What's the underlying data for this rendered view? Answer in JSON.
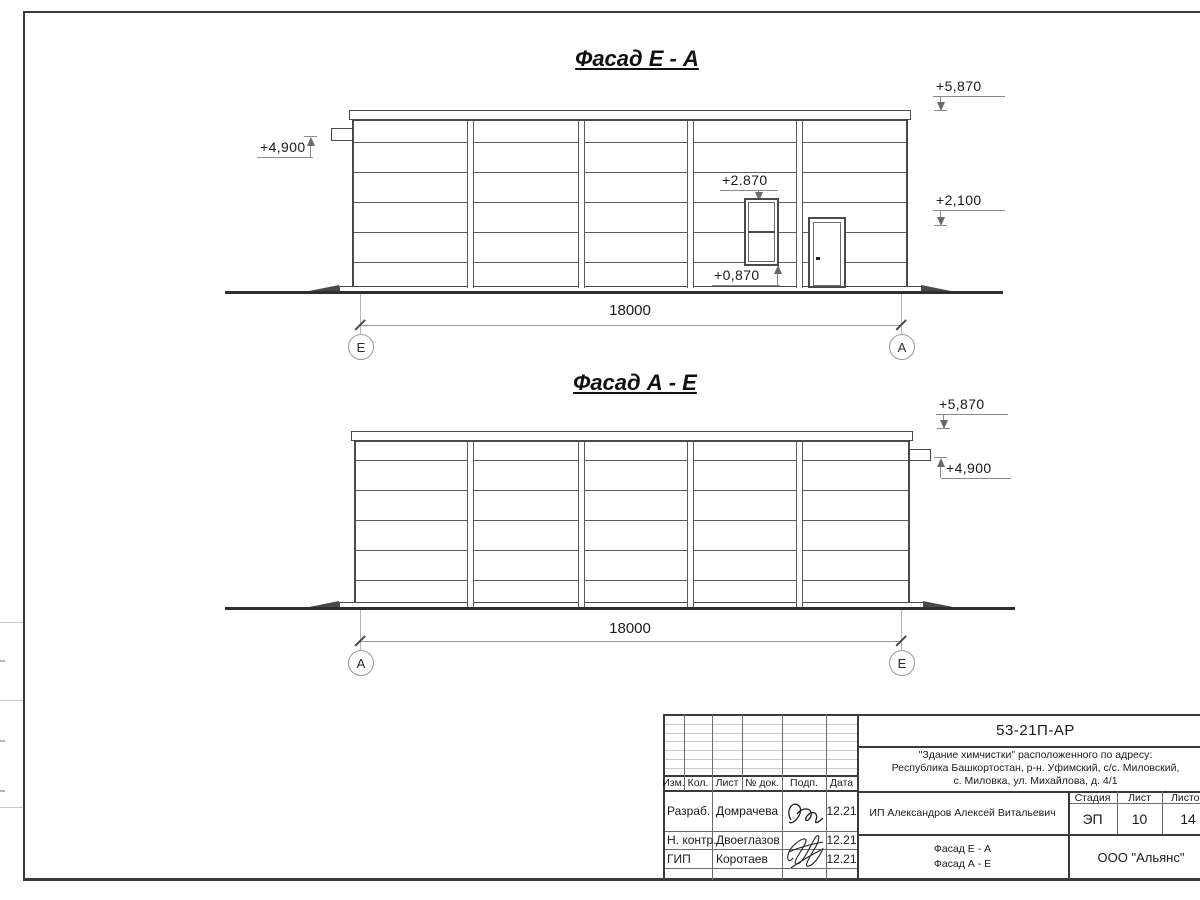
{
  "drawing": {
    "facade1": {
      "title": "Фасад Е - А",
      "dim": "18000",
      "axis_left": "Е",
      "axis_right": "А",
      "levels": {
        "roof": "+5,870",
        "mid": "+2,100",
        "pipe": "+4,900",
        "window_top": "+2.870",
        "window_sill": "+0,870"
      }
    },
    "facade2": {
      "title": "Фасад А - Е",
      "dim": "18000",
      "axis_left": "А",
      "axis_right": "Е",
      "levels": {
        "roof": "+5,870",
        "pipe": "+4,900"
      }
    }
  },
  "titleblock": {
    "doc_code": "53-21П-АР",
    "project_line1": "\"Здание химчистки\" расположенного по адресу:",
    "project_line2": "Республика Башкортостан, р-н. Уфимский, с/с. Миловский,",
    "project_line3": "с. Миловка, ул. Михайлова, д. 4/1",
    "cols": {
      "izm": "Изм.",
      "kol": "Кол.",
      "list": "Лист",
      "doc": "№ док.",
      "podp": "Подп.",
      "data": "Дата"
    },
    "rows": [
      {
        "role": "Разраб.",
        "name": "Домрачева",
        "date": "12.21"
      },
      {
        "role": "Н. контр.",
        "name": "Двоеглазов",
        "date": "12.21"
      },
      {
        "role": "ГИП",
        "name": "Коротаев",
        "date": "12.21"
      }
    ],
    "client": "ИП Александров Алексей Витальевич",
    "stage_label": "Стадия",
    "sheet_label": "Лист",
    "sheets_label": "Листов",
    "stage": "ЭП",
    "sheet_no": "10",
    "sheets_total": "14",
    "content_line1": "Фасад Е - А",
    "content_line2": "Фасад А - Е",
    "company": "ООО \"Альянс\""
  }
}
